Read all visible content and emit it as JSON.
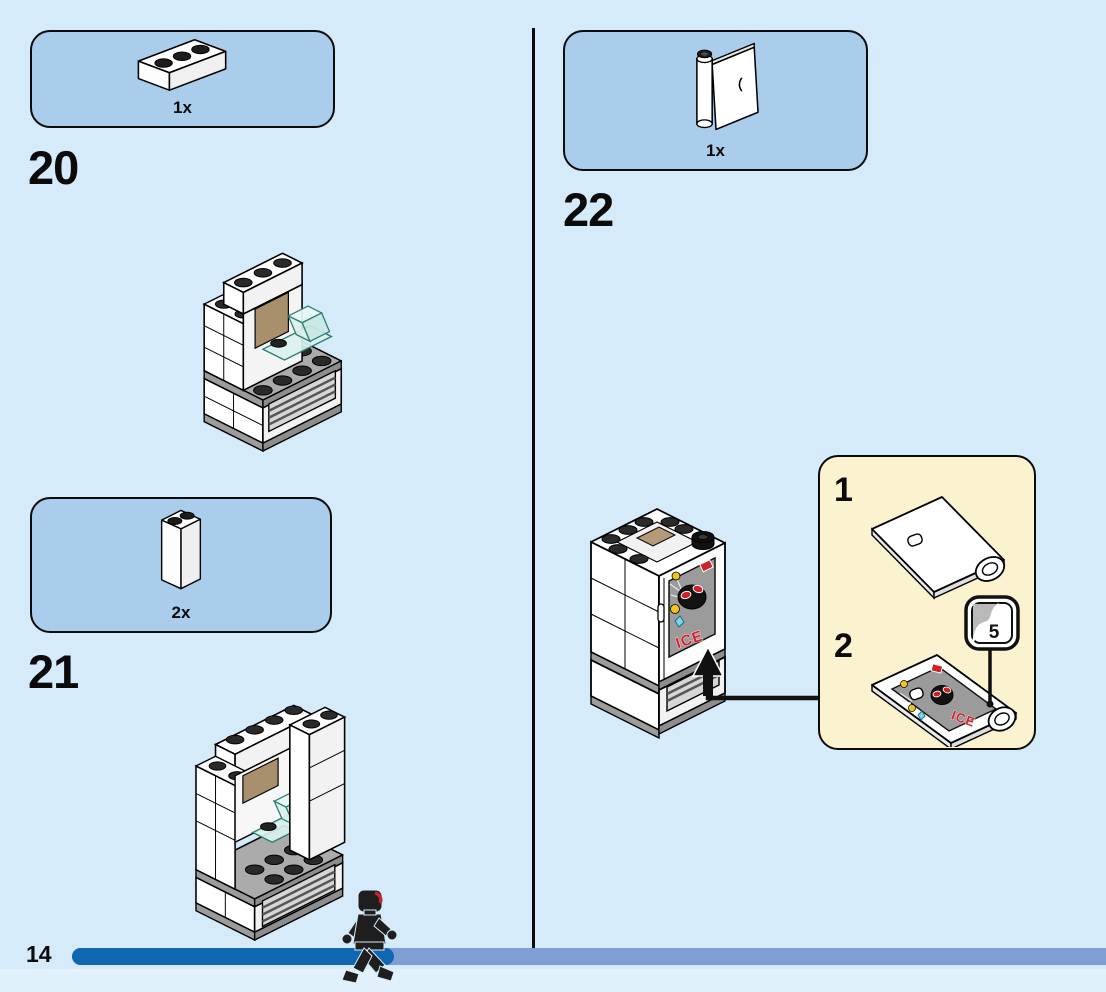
{
  "steps": {
    "step20": {
      "label": "20",
      "part_count": "1x"
    },
    "step21": {
      "label": "21",
      "part_count": "2x"
    },
    "step22": {
      "label": "22",
      "part_count": "1x"
    }
  },
  "callout": {
    "sub_step_1": "1",
    "sub_step_2": "2",
    "sticker_number": "5"
  },
  "sticker": {
    "text": "ICE"
  },
  "footer": {
    "page_number": "14"
  },
  "colors": {
    "background": "#d5ebf9",
    "parts_box_bg": "#aacdeb",
    "callout_bg": "#fbf3cf",
    "progress_filled": "#1066b1",
    "progress_track": "#7f9ed3",
    "sticker_red": "#cf202a",
    "trans_blue": "#d9f1ed",
    "tan": "#a8906c"
  }
}
